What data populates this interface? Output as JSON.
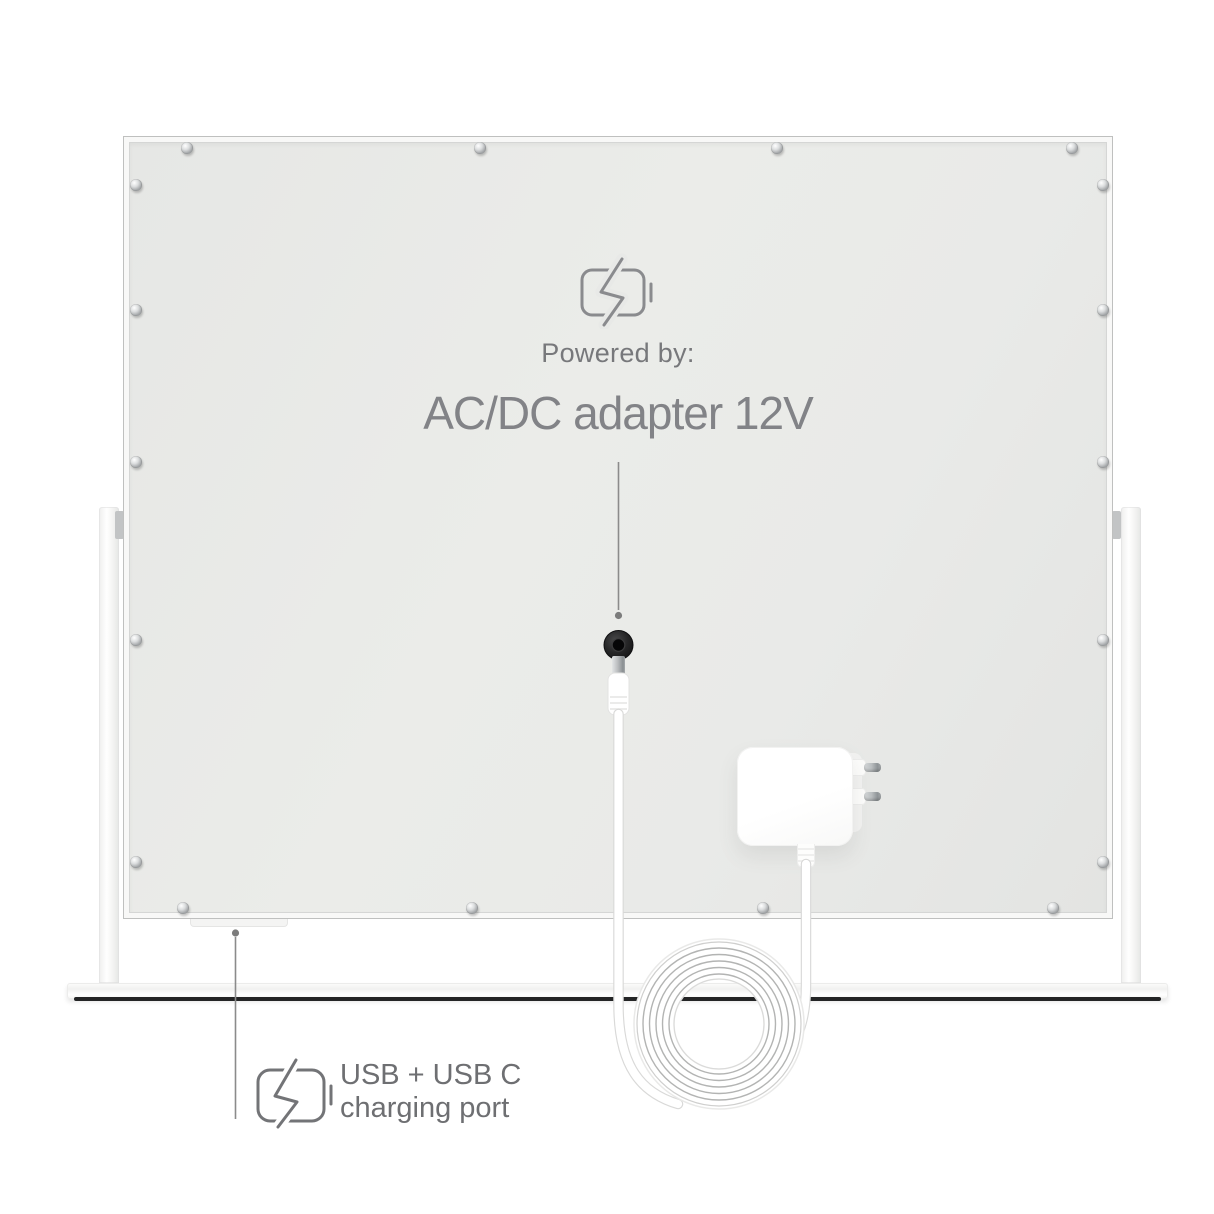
{
  "annotations": {
    "power": {
      "icon": "battery-charging-icon",
      "heading": "Powered by:",
      "title": "AC/DC adapter 12V"
    },
    "usb": {
      "icon": "battery-charging-icon",
      "label_line1": "USB + USB C",
      "label_line2": "charging port"
    }
  },
  "colors": {
    "heading_text": "#77787b",
    "title_text": "#828387",
    "usb_text": "#6e6f72",
    "icon_stroke": "#8a8b8e",
    "pointer": "#8b8b8b",
    "panel": "#e8e9e7",
    "base_strip": "#242526",
    "jack": "#1f1f20"
  }
}
